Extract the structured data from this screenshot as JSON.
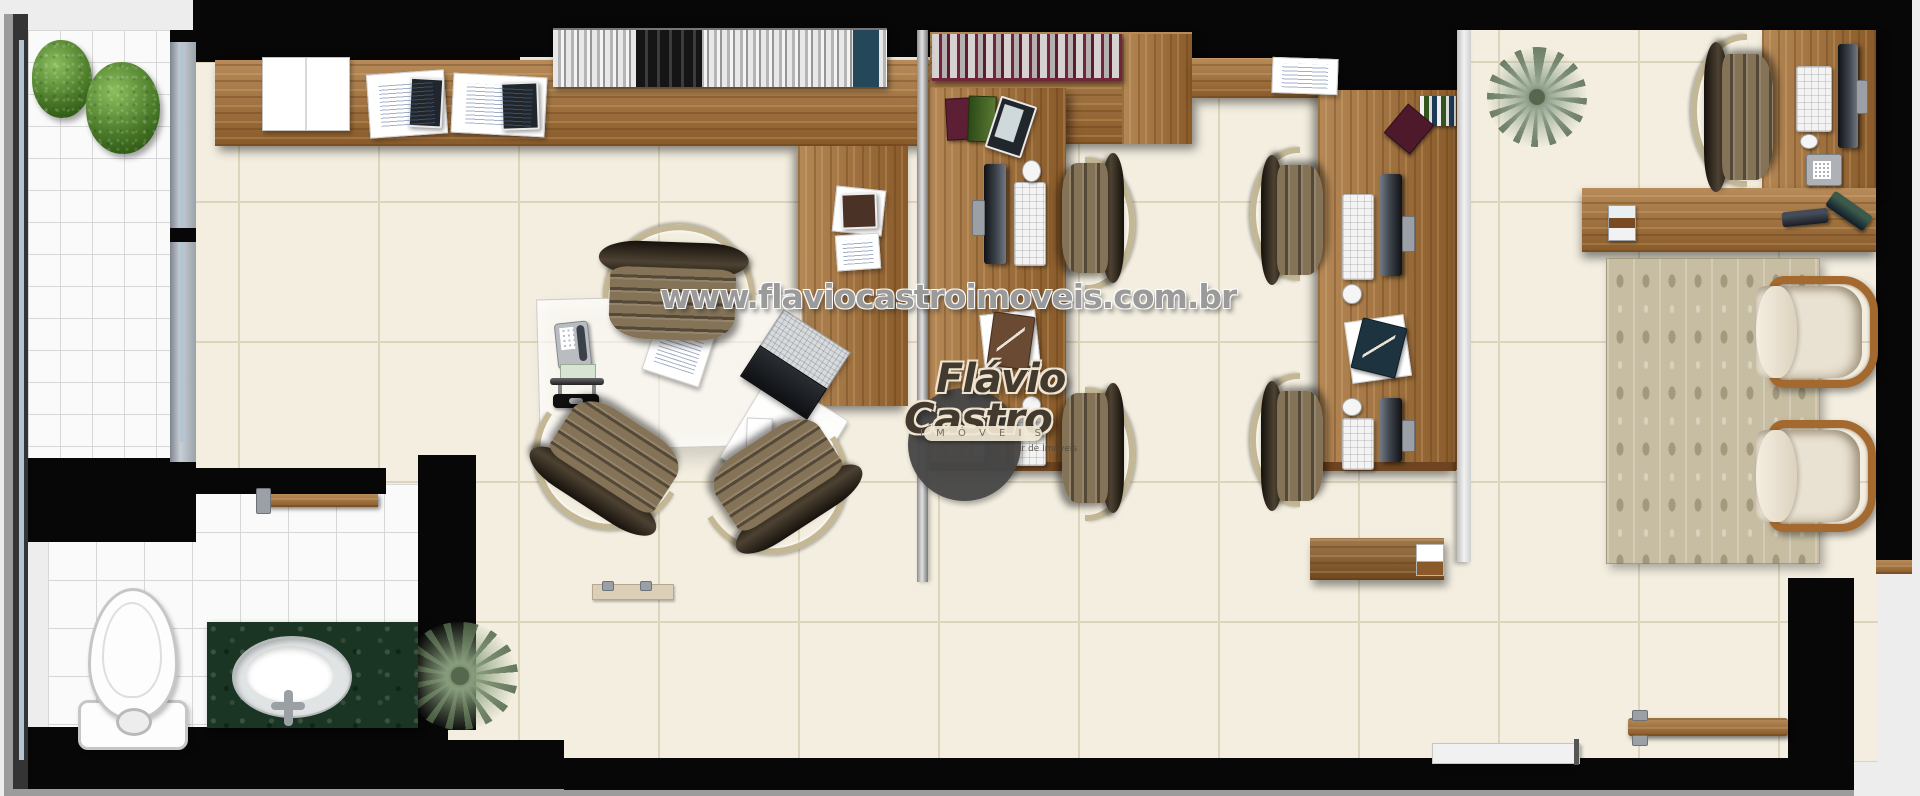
{
  "meta": {
    "title": "Real-estate office floor plan render (top view)"
  },
  "watermark": {
    "text": "www.flaviocastroimoveis.com.br"
  },
  "logo": {
    "first_name": "Flávio",
    "last_name": "Castro",
    "tagline": "I M Ó V E I S",
    "subtext1": "Corretor de Imóveis",
    "subtext2": "CRECI"
  },
  "palette": {
    "wall": "#070707",
    "floor": "#f3eee0",
    "floor_line": "#ddd4bc",
    "tile_white": "#fafafa",
    "tile_line": "#d7d7d7",
    "wood": "#9c6a35",
    "wood_dark": "#6e4520",
    "glass_blue": "#b3c4d2",
    "maroon": "#72253c",
    "chair_bronze": "#857357",
    "chair_back": "#4d4232",
    "chair_metal": "#c3b795",
    "armchair_cream": "#e9e1d1",
    "armchair_wood": "#a4692e",
    "rug": "#c7bda2",
    "marble_green": "#1b3524",
    "plant_green": "#4a7a28",
    "palm_green": "#97a893",
    "logo_gray": "#474747",
    "logo_brown": "#42392f",
    "logo_cream": "#efe4cf"
  },
  "furniture_types": [
    "balcony-shrub",
    "palm-plant",
    "work-counter",
    "bookshelf",
    "whiteboard",
    "document-stack",
    "reception-desk",
    "glass-meeting-table",
    "desk-phone",
    "desk-organizer",
    "laptop",
    "office-chair",
    "workstation-desk",
    "monitor",
    "keyboard",
    "mouse",
    "clipboard",
    "filing-cabinet",
    "executive-desk",
    "side-desk",
    "executive-chair",
    "card-holder",
    "stapler",
    "area-rug",
    "armchair",
    "toilet",
    "vanity-sink",
    "faucet",
    "entrance-door",
    "sliding-door",
    "window",
    "threshold"
  ]
}
